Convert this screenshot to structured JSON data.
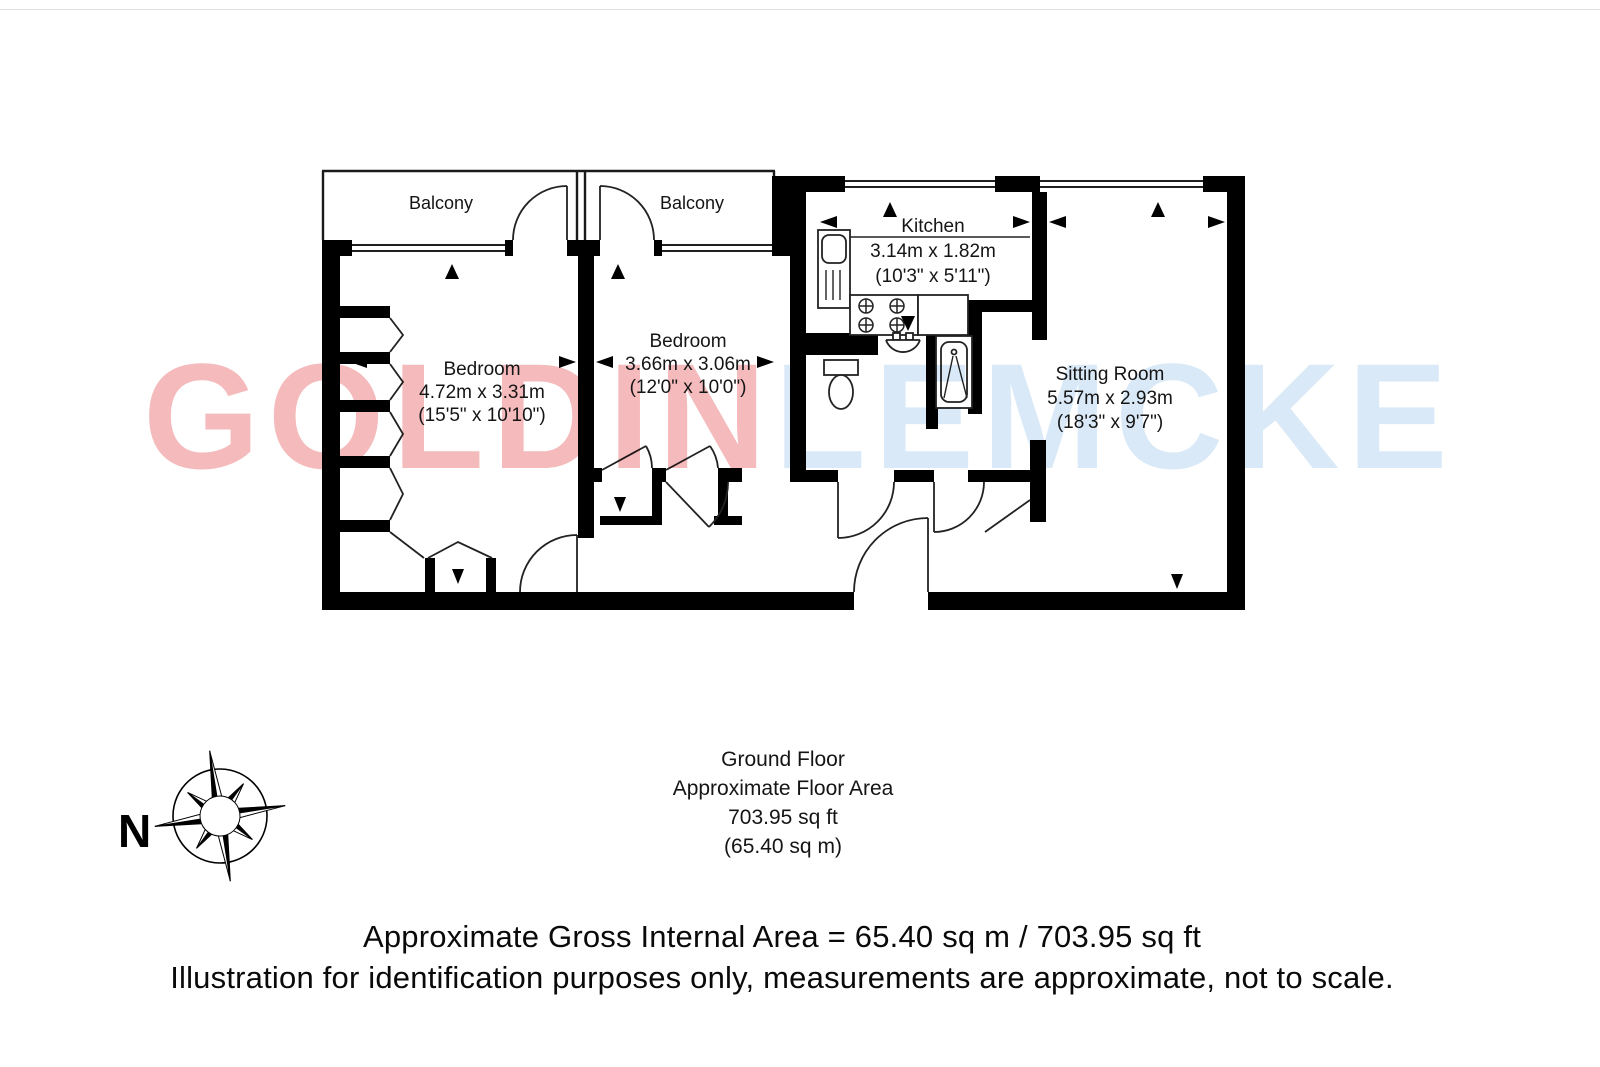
{
  "watermark": {
    "left": "GOLDIN",
    "right": "LEMCKE"
  },
  "rooms": {
    "balcony1": {
      "name": "Balcony"
    },
    "balcony2": {
      "name": "Balcony"
    },
    "bedroom1": {
      "name": "Bedroom",
      "metric": "4.72m x 3.31m",
      "imperial": "(15'5\" x 10'10\")"
    },
    "bedroom2": {
      "name": "Bedroom",
      "metric": "3.66m x 3.06m",
      "imperial": "(12'0\" x 10'0\")"
    },
    "kitchen": {
      "name": "Kitchen",
      "metric": "3.14m x 1.82m",
      "imperial": "(10'3\" x 5'11\")"
    },
    "sitting_room": {
      "name": "Sitting Room",
      "metric": "5.57m x 2.93m",
      "imperial": "(18'3\" x 9'7\")"
    }
  },
  "compass": {
    "label": "N"
  },
  "floor_summary": {
    "line1": "Ground Floor",
    "line2": "Approximate Floor Area",
    "line3": "703.95 sq ft",
    "line4": "(65.40 sq m)"
  },
  "footer": {
    "line1": "Approximate Gross Internal Area = 65.40 sq m / 703.95 sq ft",
    "line2": "Illustration for identification purposes only, measurements are approximate, not to scale."
  },
  "colors": {
    "wall": "#000000",
    "watermark_pink": "#f4babc",
    "watermark_blue": "#d9e9f7"
  }
}
